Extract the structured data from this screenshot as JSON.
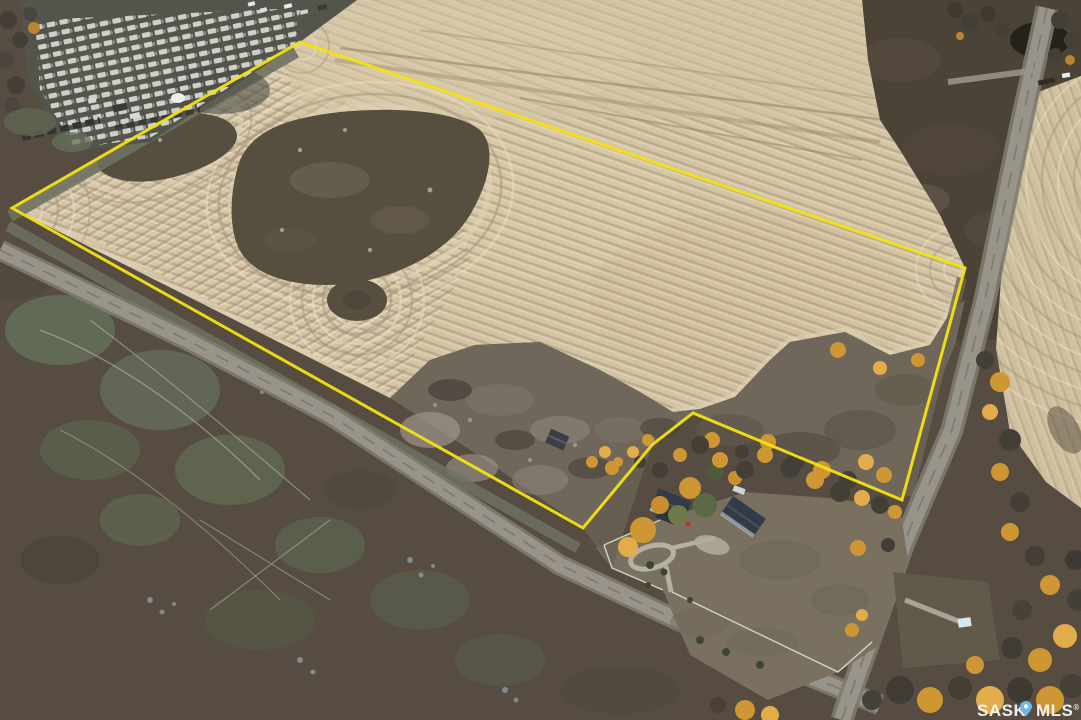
{
  "image": {
    "kind": "aerial-drone-photo",
    "subject": "harvested farmland quarter with yellow property boundary outline, farmyard, gravel roads, pasture and autumn trees"
  },
  "watermark": {
    "left": "SASK",
    "right": "MLS",
    "reg": "®"
  },
  "boundary": {
    "points": "12,208 300,42 965,268 902,500 693,413 652,445 583,528",
    "width": 3
  },
  "colors": {
    "field": "#d3c4a4",
    "fieldPale": "#e3d6ba",
    "rowDark": "#a3927a",
    "rowLight": "#ecdfc6",
    "marginLight": "#dfd2b4",
    "slough": "#564e3f",
    "sloughLight": "#6e6557",
    "scrub": "#6f6759",
    "scrubLight": "#9c968a",
    "pastureSW": "#564c41",
    "pastureNE": "#4c4337",
    "greenPatch": "#66745c",
    "blueSpeckle": "#8d9aa2",
    "trail": "#b9bdae",
    "eastField": "#cfc09f",
    "road": "#98948a",
    "roadEdge": "#7e7b70",
    "grassStrip": "#6e7160",
    "lawn": "#79705f",
    "parking": "#53544b",
    "carLight": "#dadad5",
    "carDark": "#34342f",
    "treeGold": "#cf9634",
    "treeGoldLight": "#e2ac4a",
    "treeDark": "#433f37",
    "treeGreen": "#5a6a42",
    "spruce": "#3c4733",
    "roofDark": "#333b48",
    "roofDark2": "#2c3441",
    "wallLight": "#cbced2",
    "driveway": "#b5b0a3",
    "fence": "#e6e4da",
    "boundary": "#f4e112",
    "shedWhite": "#d6e6ef",
    "watermarkText": "#fbfbfb",
    "pin": "#6cb9e6"
  }
}
